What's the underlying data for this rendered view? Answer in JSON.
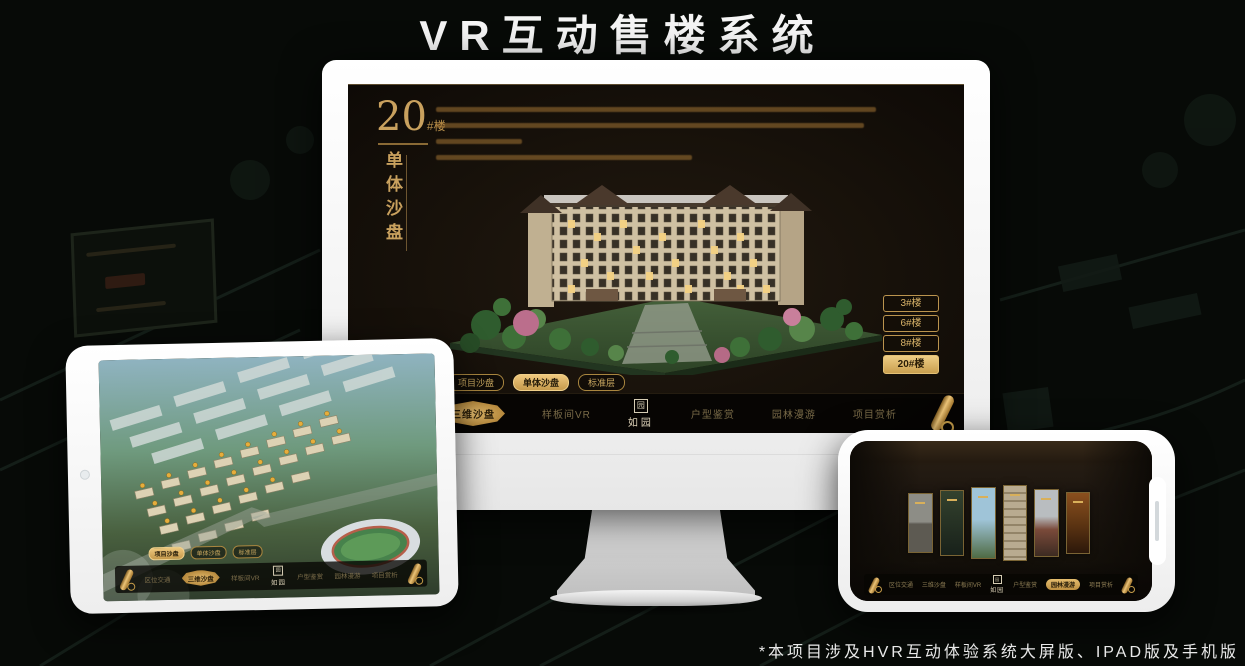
{
  "page": {
    "title": "VR互动售楼系统",
    "footnote": "*本项目涉及HVR互动体验系统大屏版、IPAD版及手机版"
  },
  "colors": {
    "gold": "#C9A15E",
    "gold_bright": "#E8C27A",
    "screen_bg": "#17110A",
    "nav_bg": "#0C0905",
    "title_text": "#F5F5F5"
  },
  "nav": {
    "logo": "如园",
    "logo_seal": "园",
    "items": [
      "区位交通",
      "三维沙盘",
      "样板间VR",
      "户型鉴赏",
      "园林漫游",
      "项目赏析"
    ]
  },
  "monitor": {
    "block": {
      "number": "20",
      "suffix": "#楼",
      "vertical_label": "单体沙盘"
    },
    "floor_buttons": [
      {
        "label": "3#楼",
        "active": false
      },
      {
        "label": "6#楼",
        "active": false
      },
      {
        "label": "8#楼",
        "active": false
      },
      {
        "label": "20#楼",
        "active": true
      }
    ],
    "sub_tabs": [
      {
        "label": "项目沙盘",
        "active": false
      },
      {
        "label": "单体沙盘",
        "active": true
      },
      {
        "label": "标准层",
        "active": false
      }
    ]
  },
  "tablet": {
    "sub_tabs": [
      {
        "label": "项目沙盘",
        "active": true
      },
      {
        "label": "单体沙盘",
        "active": false
      },
      {
        "label": "标准层",
        "active": false
      }
    ]
  }
}
